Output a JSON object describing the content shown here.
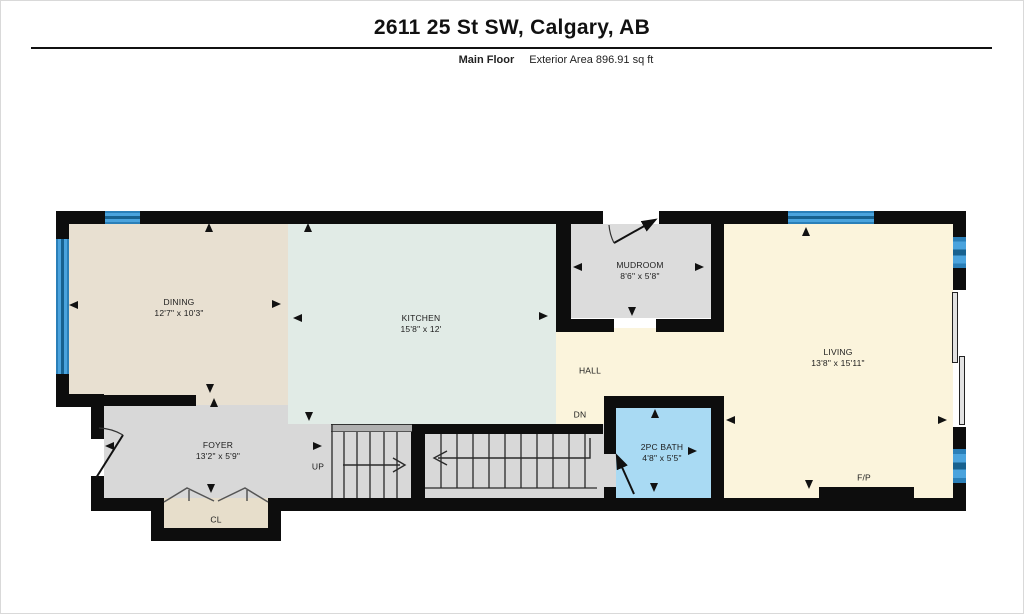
{
  "header": {
    "title": "2611 25 St SW, Calgary, AB",
    "floor_label": "Main Floor",
    "area_label": "Exterior Area 896.91 sq ft"
  },
  "rooms": {
    "dining": {
      "name": "DINING",
      "dims": "12'7\" x 10'3\""
    },
    "kitchen": {
      "name": "KITCHEN",
      "dims": "15'8\" x 12'"
    },
    "mudroom": {
      "name": "MUDROOM",
      "dims": "8'6\" x 5'8\""
    },
    "living": {
      "name": "LIVING",
      "dims": "13'8\" x 15'11\""
    },
    "hall": {
      "name": "HALL"
    },
    "foyer": {
      "name": "FOYER",
      "dims": "13'2\" x 5'9\""
    },
    "bath": {
      "name": "2PC BATH",
      "dims": "4'8\" x 5'5\""
    },
    "closet": {
      "name": "CL"
    }
  },
  "annotations": {
    "stairs_up": "UP",
    "stairs_down": "DN",
    "fireplace": "F/P"
  },
  "colors": {
    "wall": "#0d0d0d",
    "dining": "#e8e0d1",
    "kitchen": "#e1ebe6",
    "living_hall": "#fbf4dc",
    "mudroom": "#dcdcdc",
    "foyer_stairs": "#d8d8d8",
    "bath": "#a9daf3",
    "closet": "#e7decb",
    "window": "#3e9bd6"
  }
}
